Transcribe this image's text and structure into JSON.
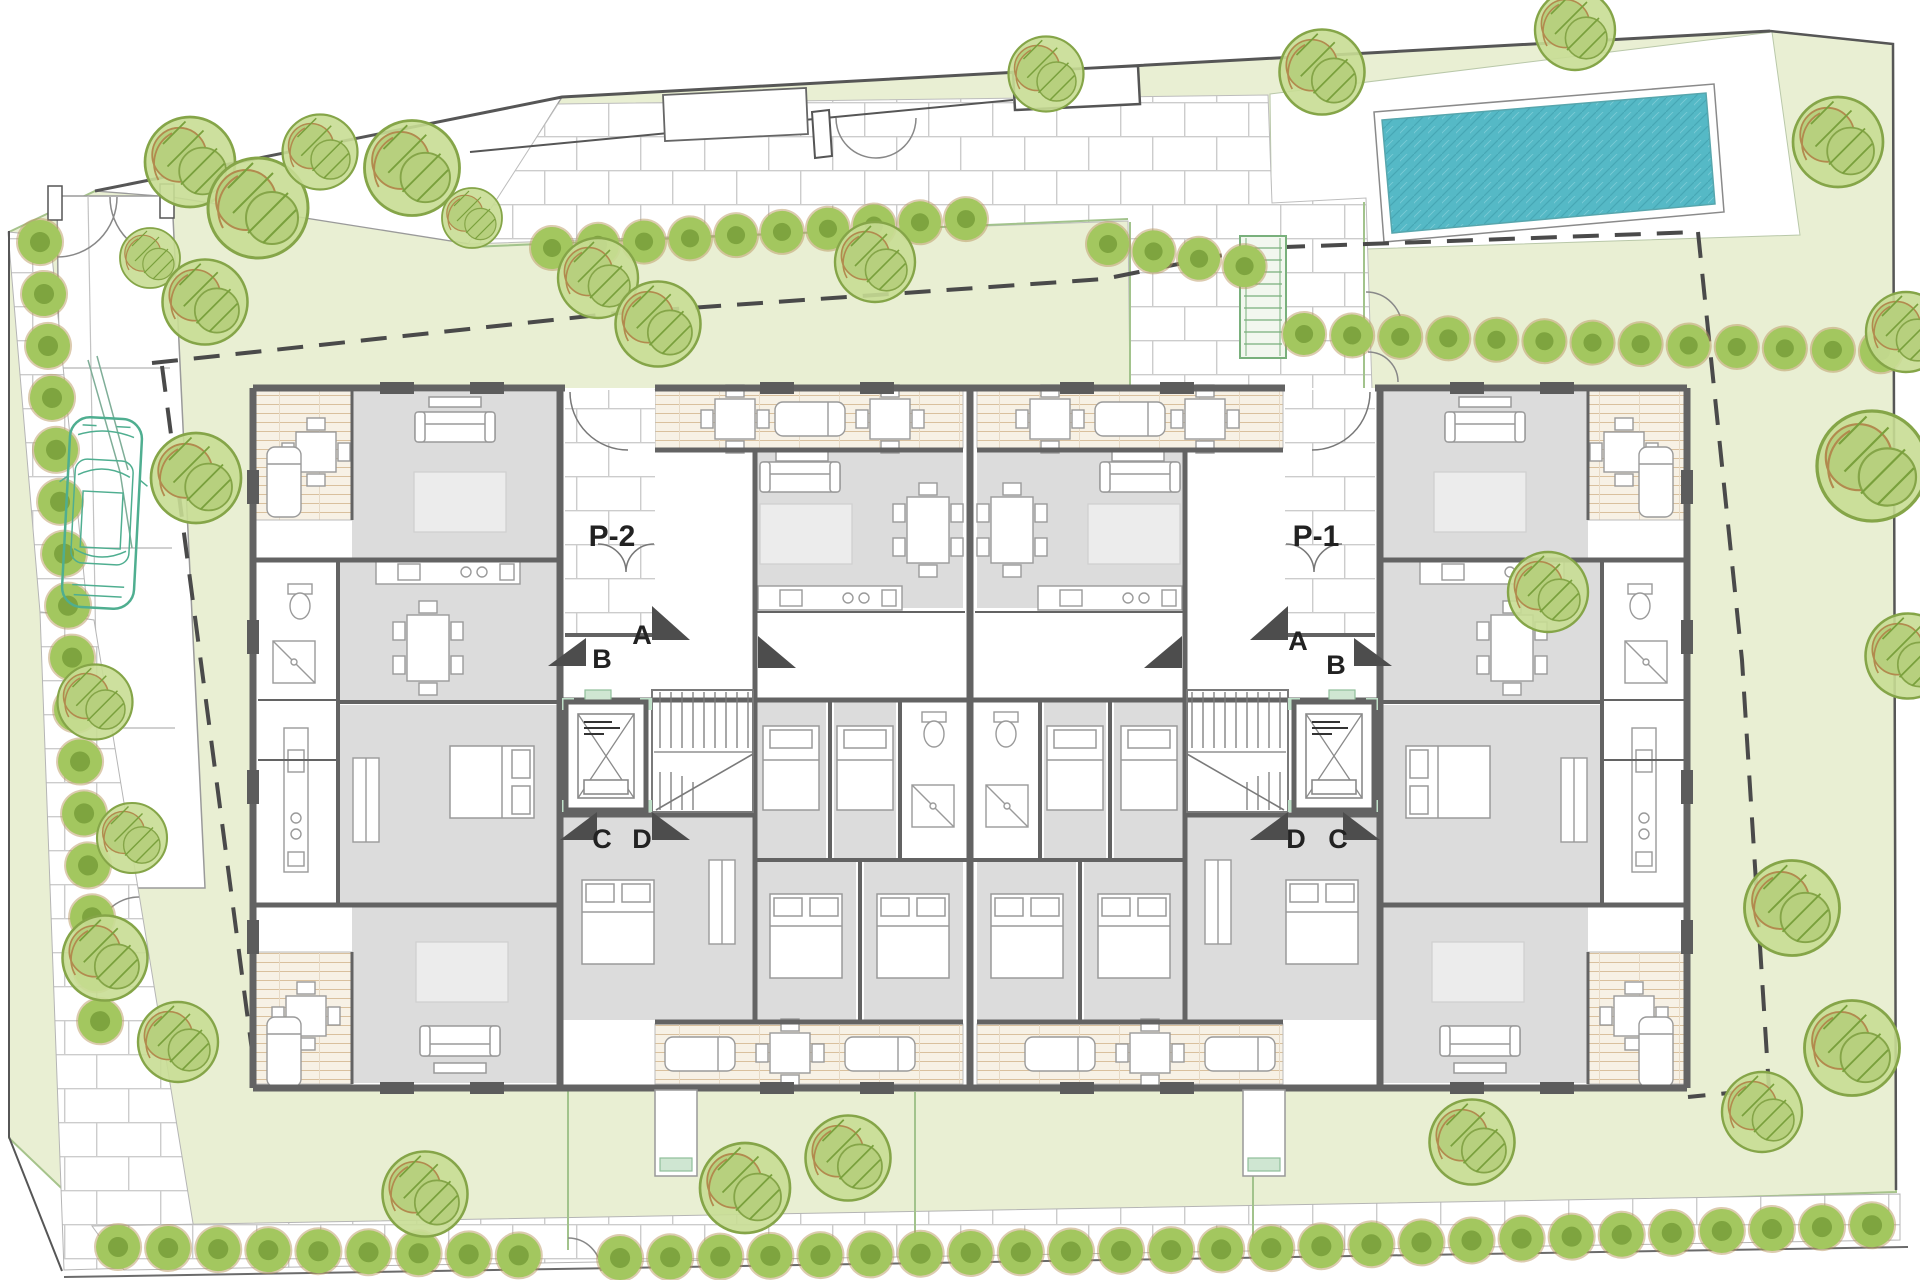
{
  "labels": {
    "block_left": "P-2",
    "block_right": "P-1",
    "door_a": "A",
    "door_b": "B",
    "door_c": "C",
    "door_d": "D"
  },
  "colors": {
    "garden": "#e9efd3",
    "garden_border": "#a6c38b",
    "paving_joint": "#cccccc",
    "terrace_bg": "#f7f1e5",
    "terrace_line": "#d9c09d",
    "wall": "#636363",
    "room": "#dcdcdc",
    "furniture_line": "#9a9a9a",
    "pool_water": "#55b9c6",
    "pool_hatch": "#46a7b5",
    "hedge": "#a3c75f",
    "hedge_dark": "#7ea43f",
    "tree_fill": "#c8dd93",
    "tree_stroke": "#85a548",
    "tree_brown": "#b28a4e",
    "boundary": "#5a5a5a",
    "dash_line": "#4a4a4a",
    "car": "#4fae90",
    "accent_green": "#bfe0c8"
  },
  "plan": {
    "trees": [
      [
        190,
        162,
        0.9
      ],
      [
        258,
        208,
        1
      ],
      [
        320,
        152,
        0.75
      ],
      [
        150,
        258,
        0.6
      ],
      [
        412,
        168,
        0.95
      ],
      [
        472,
        218,
        0.6
      ],
      [
        598,
        278,
        0.8
      ],
      [
        658,
        324,
        0.85
      ],
      [
        875,
        262,
        0.8
      ],
      [
        1046,
        74,
        0.75
      ],
      [
        1322,
        72,
        0.85
      ],
      [
        1575,
        30,
        0.8
      ],
      [
        1838,
        142,
        0.9
      ],
      [
        1906,
        332,
        0.8
      ],
      [
        1872,
        466,
        1.1
      ],
      [
        1908,
        656,
        0.85
      ],
      [
        1548,
        592,
        0.8
      ],
      [
        1792,
        908,
        0.95
      ],
      [
        1852,
        1048,
        0.95
      ],
      [
        1762,
        1112,
        0.8
      ],
      [
        1472,
        1142,
        0.85
      ],
      [
        848,
        1158,
        0.85
      ],
      [
        745,
        1188,
        0.9
      ],
      [
        425,
        1194,
        0.85
      ],
      [
        205,
        302,
        0.85
      ],
      [
        196,
        478,
        0.9
      ],
      [
        95,
        702,
        0.75
      ],
      [
        132,
        838,
        0.7
      ],
      [
        105,
        958,
        0.85
      ],
      [
        178,
        1042,
        0.8
      ]
    ],
    "furniture": [
      [
        "sofa",
        455,
        428,
        0
      ],
      [
        "tv",
        455,
        402,
        0
      ],
      [
        "rug",
        460,
        502,
        0
      ],
      [
        "kit",
        448,
        572,
        0
      ],
      [
        "tbl6",
        428,
        648,
        0
      ],
      [
        "bedD",
        492,
        782,
        90
      ],
      [
        "ward",
        366,
        800,
        0
      ],
      [
        "sofa",
        460,
        1040,
        180
      ],
      [
        "rug",
        462,
        972,
        0
      ],
      [
        "tv",
        460,
        1068,
        0
      ],
      [
        "wc",
        300,
        602,
        0
      ],
      [
        "shw",
        294,
        662,
        0
      ],
      [
        "kit",
        296,
        800,
        90
      ],
      [
        "tbl4",
        316,
        452,
        0
      ],
      [
        "lng",
        284,
        482,
        0
      ],
      [
        "tbl4",
        306,
        1016,
        0
      ],
      [
        "lng",
        284,
        1052,
        0
      ],
      [
        "sofa",
        800,
        478,
        0
      ],
      [
        "tv",
        802,
        456,
        0
      ],
      [
        "rug",
        806,
        534,
        0
      ],
      [
        "tbl6",
        928,
        530,
        0
      ],
      [
        "kit",
        830,
        598,
        0
      ],
      [
        "bedS",
        791,
        768,
        0
      ],
      [
        "bedS",
        865,
        768,
        0
      ],
      [
        "wc",
        934,
        730,
        0
      ],
      [
        "shw",
        933,
        806,
        0
      ],
      [
        "bedD",
        806,
        936,
        0
      ],
      [
        "bedD",
        913,
        936,
        0
      ],
      [
        "tbl4",
        735,
        419,
        0
      ],
      [
        "lng",
        810,
        419,
        90
      ],
      [
        "tbl4",
        890,
        419,
        0
      ],
      [
        "lng",
        700,
        1054,
        90
      ],
      [
        "tbl4",
        790,
        1053,
        0
      ],
      [
        "lng",
        880,
        1054,
        90
      ],
      [
        "bedD",
        618,
        922,
        0
      ],
      [
        "ward",
        722,
        902,
        0
      ],
      [
        "sofa",
        1485,
        428,
        0
      ],
      [
        "tv",
        1485,
        402,
        0
      ],
      [
        "rug",
        1480,
        502,
        0
      ],
      [
        "kit",
        1492,
        572,
        0
      ],
      [
        "tbl6",
        1512,
        648,
        0
      ],
      [
        "bedD",
        1448,
        782,
        -90
      ],
      [
        "ward",
        1574,
        800,
        0
      ],
      [
        "sofa",
        1480,
        1040,
        180
      ],
      [
        "rug",
        1478,
        972,
        0
      ],
      [
        "tv",
        1480,
        1068,
        0
      ],
      [
        "wc",
        1640,
        602,
        0
      ],
      [
        "shw",
        1646,
        662,
        0
      ],
      [
        "kit",
        1644,
        800,
        90
      ],
      [
        "tbl4",
        1624,
        452,
        0
      ],
      [
        "lng",
        1656,
        482,
        0
      ],
      [
        "tbl4",
        1634,
        1016,
        0
      ],
      [
        "lng",
        1656,
        1052,
        0
      ],
      [
        "sofa",
        1140,
        478,
        0
      ],
      [
        "tv",
        1138,
        456,
        0
      ],
      [
        "rug",
        1134,
        534,
        0
      ],
      [
        "tbl6",
        1012,
        530,
        0
      ],
      [
        "kit",
        1110,
        598,
        0
      ],
      [
        "bedS",
        1149,
        768,
        0
      ],
      [
        "bedS",
        1075,
        768,
        0
      ],
      [
        "wc",
        1006,
        730,
        0
      ],
      [
        "shw",
        1007,
        806,
        0
      ],
      [
        "bedD",
        1134,
        936,
        0
      ],
      [
        "bedD",
        1027,
        936,
        0
      ],
      [
        "tbl4",
        1205,
        419,
        0
      ],
      [
        "lng",
        1130,
        419,
        90
      ],
      [
        "tbl4",
        1050,
        419,
        0
      ],
      [
        "lng",
        1240,
        1054,
        90
      ],
      [
        "tbl4",
        1150,
        1053,
        0
      ],
      [
        "lng",
        1060,
        1054,
        90
      ],
      [
        "bedD",
        1322,
        922,
        0
      ],
      [
        "ward",
        1218,
        902,
        0
      ]
    ]
  }
}
